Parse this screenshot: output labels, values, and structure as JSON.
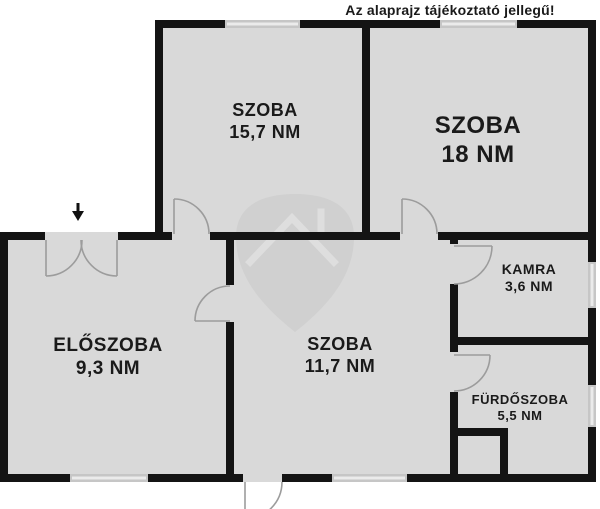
{
  "header": {
    "disclaimer": "Az alaprajz tájékoztató jellegű!"
  },
  "rooms": [
    {
      "key": "szoba_157",
      "name": "SZOBA",
      "area": "15,7 NM"
    },
    {
      "key": "szoba_18",
      "name": "SZOBA",
      "area": "18 NM"
    },
    {
      "key": "eloszoba",
      "name": "ELŐSZOBA",
      "area": "9,3 NM"
    },
    {
      "key": "szoba_117",
      "name": "SZOBA",
      "area": "11,7 NM"
    },
    {
      "key": "kamra",
      "name": "KAMRA",
      "area": "3,6 NM"
    },
    {
      "key": "furdoszoba",
      "name": "FÜRDŐSZOBA",
      "area": "5,5 NM"
    }
  ],
  "icons": {
    "entrance_arrow": "down-arrow",
    "watermark": "shield-with-roof-logo"
  },
  "colors": {
    "background": "#ffffff",
    "wall": "#141414",
    "room_fill": "#d9d9d9",
    "window_fill": "#c6c6c6",
    "door_line": "#9c9c9c",
    "watermark": "#d0d0d0",
    "text": "#1a1a1a"
  }
}
